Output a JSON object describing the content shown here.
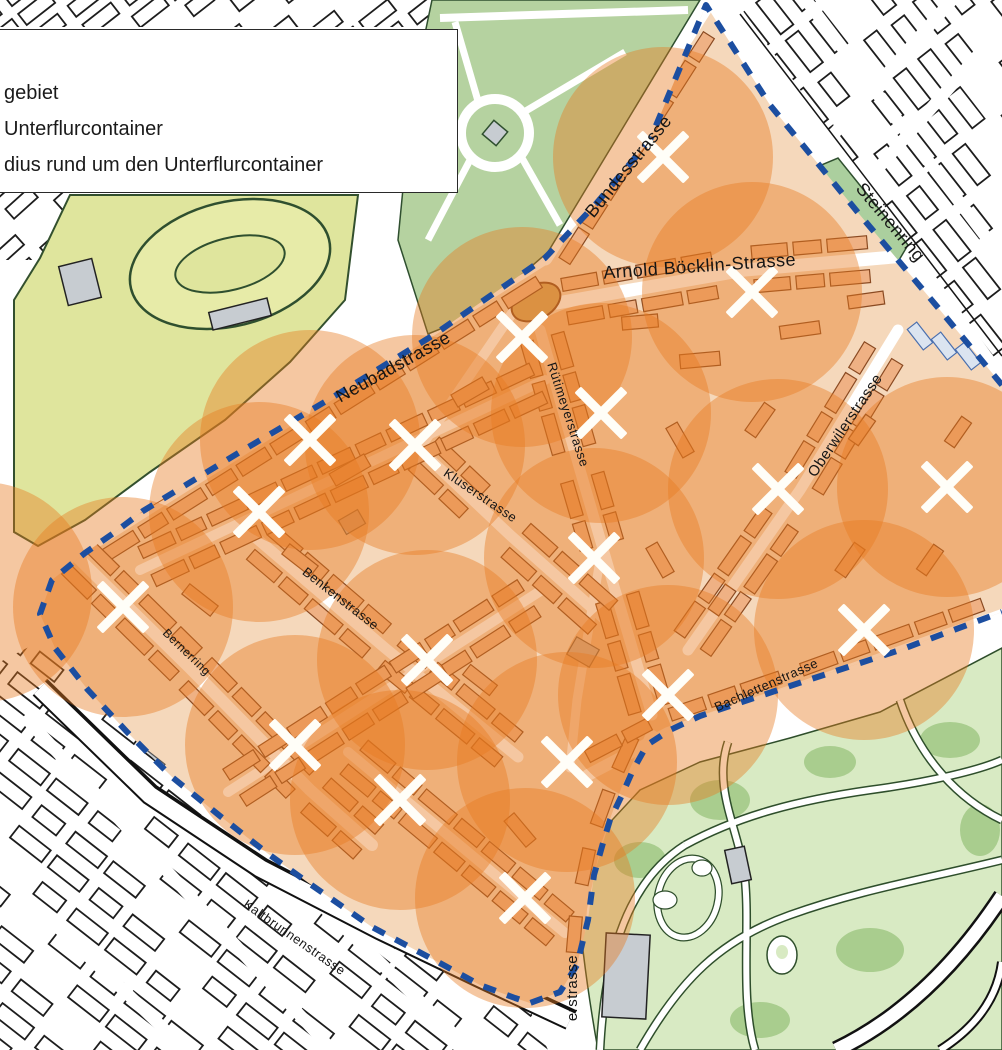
{
  "legend": {
    "items": [
      {
        "label": "gebiet"
      },
      {
        "label": "Unterflurcontainer"
      },
      {
        "label": "dius rund um den Unterflurcontainer"
      }
    ]
  },
  "map": {
    "radius": 110,
    "colors": {
      "circle": "#e87a20",
      "circle_opacity": 0.42,
      "boundary": "#1c4ea0",
      "marker": "#fffef8",
      "label": "#151515",
      "pilot_building": "#efb184",
      "outside_building": "#ffffff",
      "park_yellow": "#dfe59d",
      "park_green": "#b5d2a0",
      "zoo_green": "#d8eac3"
    },
    "containers": [
      {
        "x": 663,
        "y": 157
      },
      {
        "x": 752,
        "y": 292
      },
      {
        "x": 522,
        "y": 337
      },
      {
        "x": 601,
        "y": 413
      },
      {
        "x": 310,
        "y": 440
      },
      {
        "x": 415,
        "y": 445
      },
      {
        "x": 259,
        "y": 512
      },
      {
        "x": 778,
        "y": 489
      },
      {
        "x": 947,
        "y": 487
      },
      {
        "x": 594,
        "y": 558
      },
      {
        "x": 123,
        "y": 607
      },
      {
        "x": 864,
        "y": 630
      },
      {
        "x": 427,
        "y": 660
      },
      {
        "x": 668,
        "y": 695
      },
      {
        "x": 295,
        "y": 745
      },
      {
        "x": 567,
        "y": 762
      },
      {
        "x": 400,
        "y": 800
      },
      {
        "x": 525,
        "y": 898
      }
    ],
    "extra_circles": [
      {
        "x": -18,
        "y": 592
      }
    ],
    "street_labels": [
      {
        "name": "Bundesstrasse",
        "x": 633,
        "y": 170,
        "rot": -51,
        "size": 18
      },
      {
        "name": "Steinenring",
        "x": 886,
        "y": 226,
        "rot": 50,
        "size": 18
      },
      {
        "name": "Arnold Böcklin-Strasse",
        "x": 700,
        "y": 272,
        "rot": -4,
        "size": 18
      },
      {
        "name": "Neubadstrasse",
        "x": 396,
        "y": 372,
        "rot": -29,
        "size": 18
      },
      {
        "name": "Rütimeyerstrasse",
        "x": 564,
        "y": 416,
        "rot": 72,
        "size": 13
      },
      {
        "name": "Kluserstrasse",
        "x": 478,
        "y": 499,
        "rot": 34,
        "size": 13
      },
      {
        "name": "Oberwilerstrasse",
        "x": 849,
        "y": 428,
        "rot": -56,
        "size": 15
      },
      {
        "name": "Benkenstrasse",
        "x": 338,
        "y": 602,
        "rot": 38,
        "size": 13
      },
      {
        "name": "Bernerring",
        "x": 184,
        "y": 655,
        "rot": 44,
        "size": 12
      },
      {
        "name": "Bachlettenstrasse",
        "x": 768,
        "y": 689,
        "rot": -24,
        "size": 13
      },
      {
        "name": "Kaltbrunnenstrasse",
        "x": 292,
        "y": 941,
        "rot": 35,
        "size": 13
      },
      {
        "name": "erstrasse",
        "x": 577,
        "y": 988,
        "rot": -90,
        "size": 15
      }
    ]
  }
}
